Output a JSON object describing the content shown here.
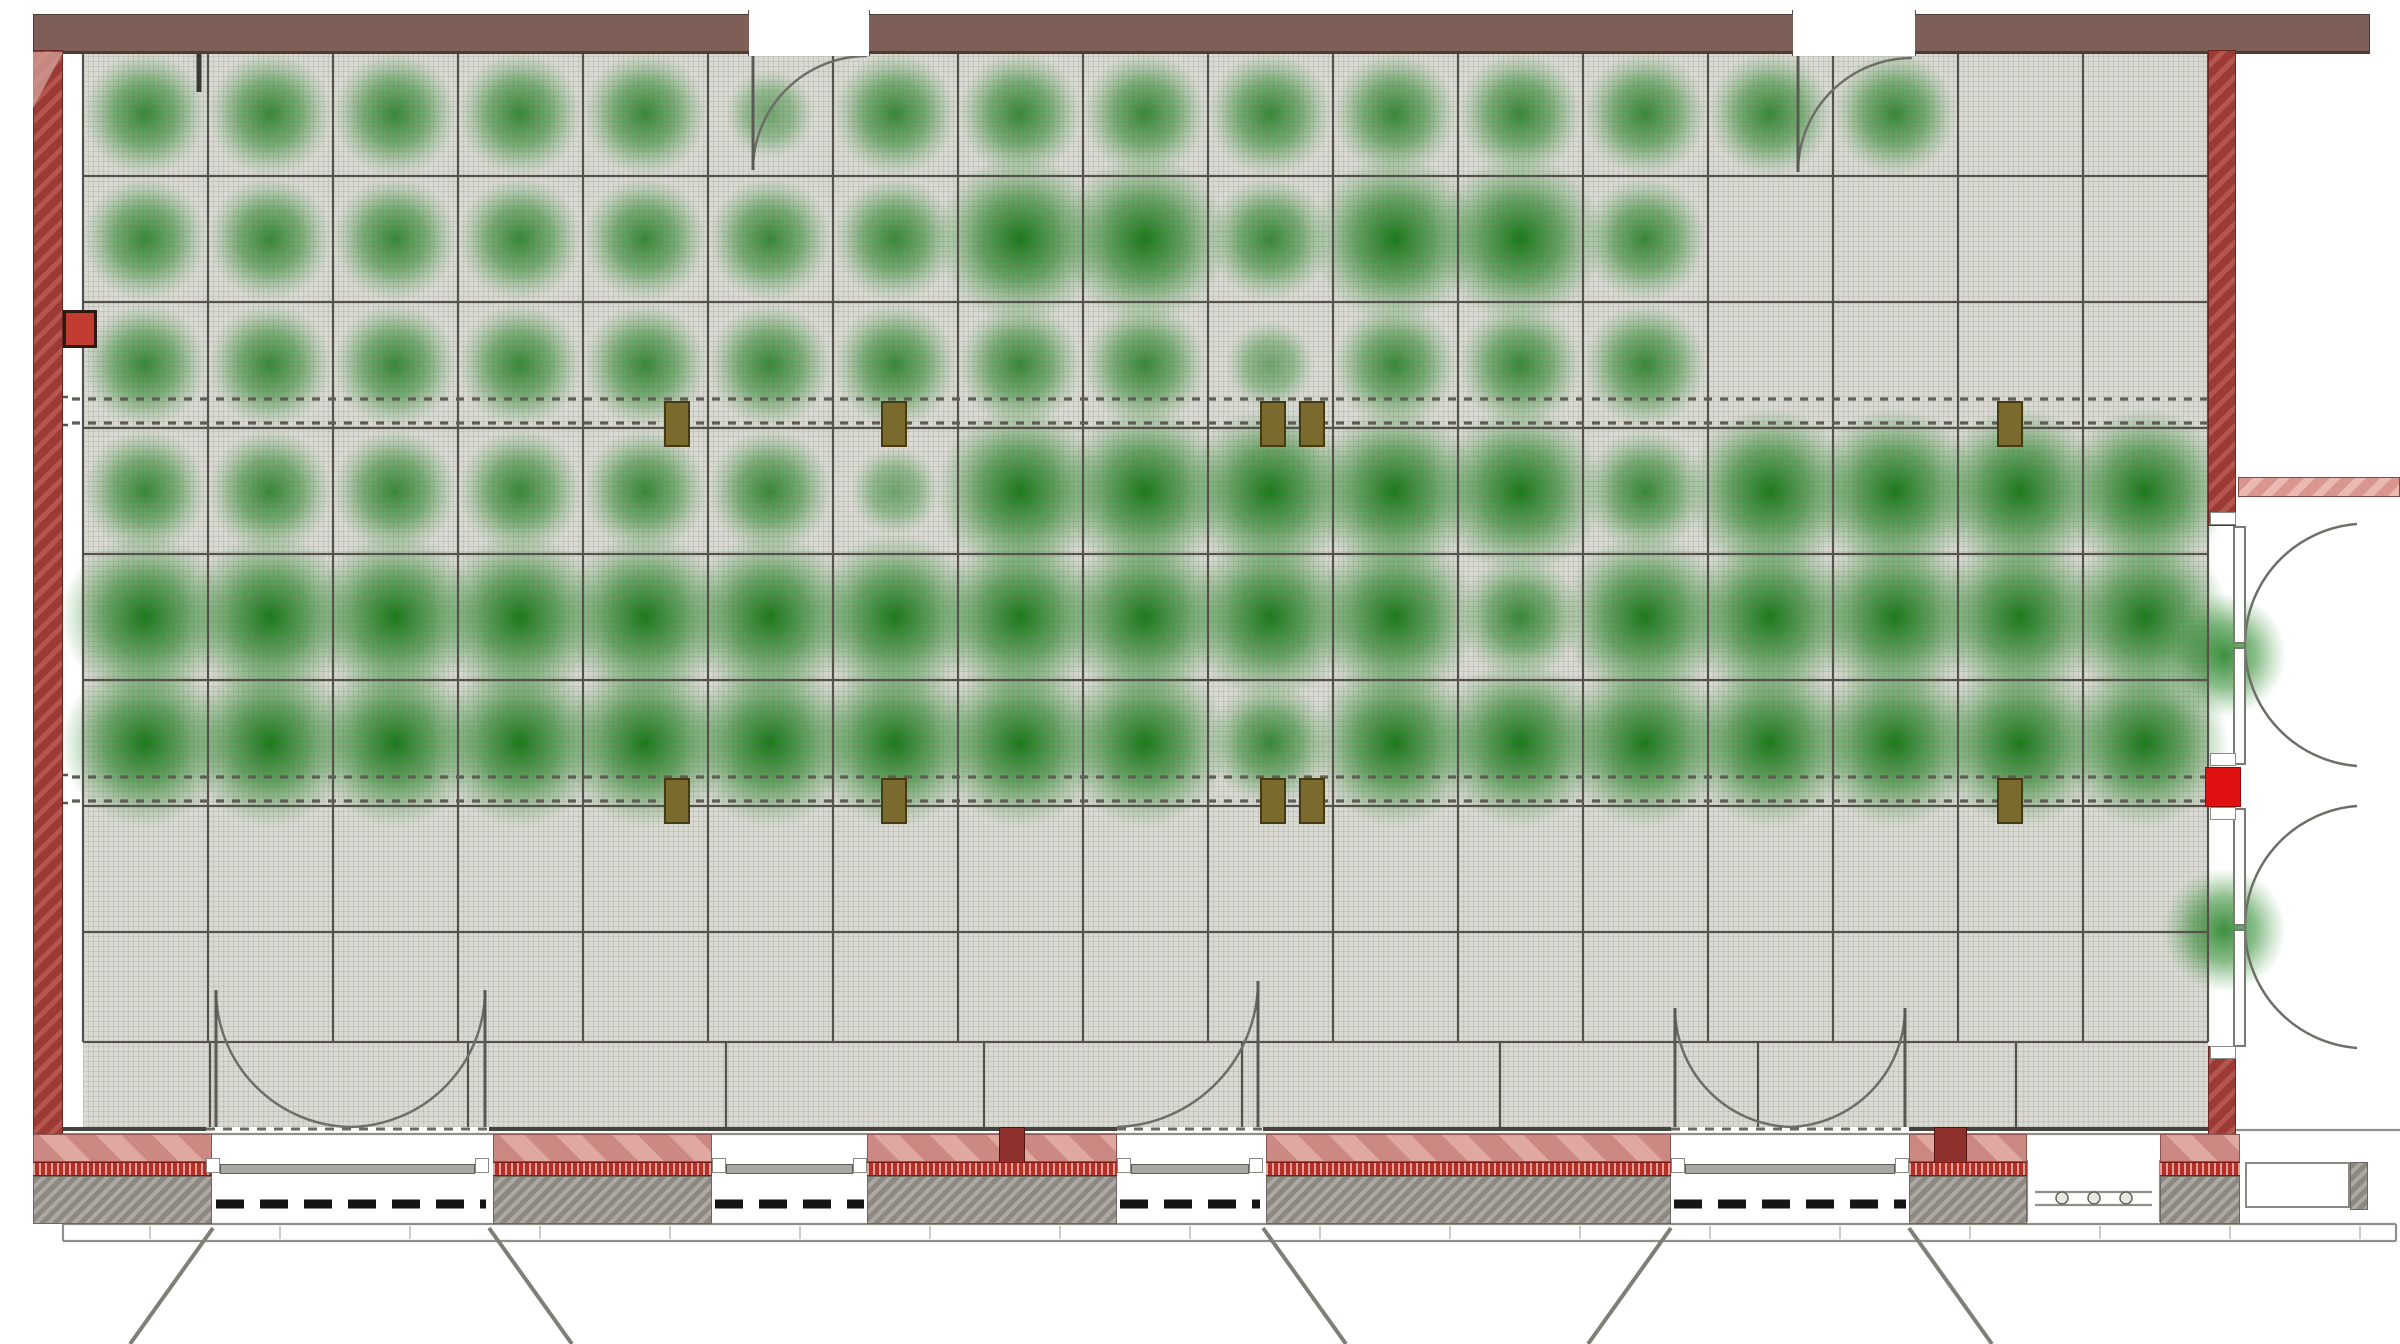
{
  "plan": {
    "canvas": {
      "w": 2400,
      "h": 1344
    },
    "colors": {
      "floor": "#dadad4",
      "wall_brown": "#7d5f57",
      "wall_red": "#a8443d",
      "bright_red": "#e01010",
      "green_core": "#147414",
      "pink_panel": "#d2928c",
      "red_strip": "#b52f25",
      "gray_pier": "#9c968f",
      "marker_olive": "#7a6a2e",
      "grid_line": "#54524b",
      "arc_line": "#6e6e68",
      "black_dash": "#151515"
    },
    "floor": {
      "x": 83,
      "y": 52,
      "w": 2125,
      "h": 1075
    },
    "grid": {
      "v_xs": [
        83,
        208,
        333,
        458,
        583,
        708,
        833,
        958,
        1083,
        1208,
        1333,
        1458,
        1583,
        1708,
        1833,
        1958,
        2083,
        2208
      ],
      "v_y1": 52,
      "v_y2": 1042,
      "h_ys": [
        52,
        176,
        302,
        428,
        554,
        680,
        806,
        932,
        1042
      ],
      "h_x1": 83,
      "h_x2": 2208,
      "walkway_xs": [
        210,
        468,
        726,
        984,
        1242,
        1500,
        1758,
        2016
      ],
      "walkway_y1": 1042,
      "walkway_y2": 1127
    },
    "blobs": {
      "col_centers": [
        145,
        270,
        395,
        520,
        645,
        770,
        895,
        1020,
        1145,
        1270,
        1395,
        1520,
        1645,
        1770,
        1895,
        2020,
        2145
      ],
      "row_centers": [
        114,
        239,
        365,
        491,
        617,
        743
      ],
      "matrix": [
        [
          2,
          2,
          2,
          2,
          2,
          1,
          2,
          2,
          2,
          2,
          2,
          2,
          2,
          2,
          2,
          0,
          0
        ],
        [
          2,
          2,
          2,
          2,
          2,
          2,
          2,
          3,
          3,
          2,
          3,
          3,
          2,
          0,
          0,
          0,
          0
        ],
        [
          2,
          2,
          2,
          2,
          2,
          2,
          2,
          2,
          2,
          1,
          2,
          2,
          2,
          0,
          0,
          0,
          0
        ],
        [
          2,
          2,
          2,
          2,
          2,
          2,
          1,
          3,
          3,
          3,
          3,
          3,
          2,
          3,
          3,
          3,
          3
        ],
        [
          3,
          3,
          3,
          3,
          3,
          3,
          3,
          3,
          3,
          3,
          3,
          2,
          3,
          3,
          3,
          3,
          3
        ],
        [
          3,
          3,
          3,
          3,
          3,
          3,
          3,
          3,
          3,
          2,
          3,
          3,
          3,
          3,
          3,
          3,
          3
        ]
      ],
      "extra": [
        {
          "x": 2224,
          "y": 655,
          "i": 2
        },
        {
          "x": 2224,
          "y": 930,
          "i": 2
        }
      ]
    },
    "rects": [
      {
        "n": "top-wall",
        "x": 33,
        "y": 14,
        "w": 2337,
        "h": 40,
        "c": "wallBrown"
      },
      {
        "n": "top-door-gap-1",
        "x": 749,
        "y": 10,
        "w": 120,
        "h": 46,
        "c": "white"
      },
      {
        "n": "top-door-gap-2",
        "x": 1793,
        "y": 10,
        "w": 122,
        "h": 46,
        "c": "white"
      },
      {
        "n": "left-wall",
        "x": 33,
        "y": 50,
        "w": 30,
        "h": 1086,
        "c": "wallRed"
      },
      {
        "n": "left-wall-corner-bevel",
        "x": 33,
        "y": 52,
        "w": 30,
        "h": 56,
        "c": "cornerTri"
      },
      {
        "n": "right-wall-upper",
        "x": 2208,
        "y": 50,
        "w": 28,
        "h": 476,
        "c": "wallRed"
      },
      {
        "n": "right-wall-lower",
        "x": 2208,
        "y": 1046,
        "w": 28,
        "h": 92,
        "c": "wallRed"
      },
      {
        "n": "right-wall-red-block",
        "x": 2205,
        "y": 767,
        "w": 36,
        "h": 40,
        "c": "redBright"
      },
      {
        "n": "right-pink-ledge",
        "x": 2238,
        "y": 477,
        "w": 162,
        "h": 20,
        "c": "pinkHatchR"
      },
      {
        "n": "outlet-box",
        "x": 63,
        "y": 310,
        "w": 34,
        "h": 38,
        "c": "outlet"
      },
      {
        "n": "window-panel-1",
        "x": 33,
        "y": 1134,
        "w": 179,
        "h": 28,
        "c": "pinkPanel"
      },
      {
        "n": "window-panel-2",
        "x": 493,
        "y": 1134,
        "w": 219,
        "h": 28,
        "c": "pinkPanel"
      },
      {
        "n": "window-panel-3",
        "x": 867,
        "y": 1134,
        "w": 250,
        "h": 28,
        "c": "pinkPanel"
      },
      {
        "n": "window-panel-4",
        "x": 1266,
        "y": 1134,
        "w": 405,
        "h": 28,
        "c": "pinkPanel"
      },
      {
        "n": "window-panel-5",
        "x": 1909,
        "y": 1134,
        "w": 118,
        "h": 28,
        "c": "pinkPanel"
      },
      {
        "n": "window-panel-6",
        "x": 2160,
        "y": 1134,
        "w": 80,
        "h": 28,
        "c": "pinkPanel"
      },
      {
        "n": "mullion-1",
        "x": 999,
        "y": 1127,
        "w": 26,
        "h": 36,
        "c": "redDark"
      },
      {
        "n": "mullion-2",
        "x": 1934,
        "y": 1127,
        "w": 33,
        "h": 36,
        "c": "redDark"
      },
      {
        "n": "red-strip-1",
        "x": 33,
        "y": 1162,
        "w": 179,
        "h": 14,
        "c": "redStrip"
      },
      {
        "n": "red-strip-2",
        "x": 493,
        "y": 1162,
        "w": 219,
        "h": 14,
        "c": "redStrip"
      },
      {
        "n": "red-strip-3",
        "x": 867,
        "y": 1162,
        "w": 250,
        "h": 14,
        "c": "redStrip"
      },
      {
        "n": "red-strip-4",
        "x": 1266,
        "y": 1162,
        "w": 405,
        "h": 14,
        "c": "redStrip"
      },
      {
        "n": "red-strip-5",
        "x": 1909,
        "y": 1162,
        "w": 118,
        "h": 14,
        "c": "redStrip"
      },
      {
        "n": "red-strip-6",
        "x": 2160,
        "y": 1162,
        "w": 80,
        "h": 14,
        "c": "redStrip"
      },
      {
        "n": "masonry-pier-1",
        "x": 33,
        "y": 1176,
        "w": 179,
        "h": 48,
        "c": "grayPier"
      },
      {
        "n": "masonry-pier-2",
        "x": 493,
        "y": 1176,
        "w": 219,
        "h": 48,
        "c": "grayPier"
      },
      {
        "n": "masonry-pier-3",
        "x": 867,
        "y": 1176,
        "w": 250,
        "h": 48,
        "c": "grayPier"
      },
      {
        "n": "masonry-pier-4",
        "x": 1266,
        "y": 1176,
        "w": 405,
        "h": 48,
        "c": "grayPier"
      },
      {
        "n": "masonry-pier-5",
        "x": 1909,
        "y": 1176,
        "w": 118,
        "h": 48,
        "c": "grayPier"
      },
      {
        "n": "masonry-pier-6",
        "x": 2160,
        "y": 1176,
        "w": 80,
        "h": 48,
        "c": "grayPier"
      },
      {
        "n": "masonry-pier-east",
        "x": 2350,
        "y": 1162,
        "w": 18,
        "h": 48,
        "c": "grayPier"
      },
      {
        "n": "window-frame-east",
        "x": 2245,
        "y": 1162,
        "w": 105,
        "h": 46,
        "c": "frame"
      },
      {
        "n": "door-jamb",
        "x": 206,
        "y": 1158,
        "w": 14,
        "h": 15,
        "c": "jamb"
      },
      {
        "n": "door-jamb",
        "x": 475,
        "y": 1158,
        "w": 14,
        "h": 15,
        "c": "jamb"
      },
      {
        "n": "door-jamb",
        "x": 712,
        "y": 1158,
        "w": 14,
        "h": 15,
        "c": "jamb"
      },
      {
        "n": "door-jamb",
        "x": 853,
        "y": 1158,
        "w": 14,
        "h": 15,
        "c": "jamb"
      },
      {
        "n": "door-jamb",
        "x": 1117,
        "y": 1158,
        "w": 14,
        "h": 15,
        "c": "jamb"
      },
      {
        "n": "door-jamb",
        "x": 1249,
        "y": 1158,
        "w": 14,
        "h": 15,
        "c": "jamb"
      },
      {
        "n": "door-jamb",
        "x": 1671,
        "y": 1158,
        "w": 14,
        "h": 15,
        "c": "jamb"
      },
      {
        "n": "door-jamb",
        "x": 1895,
        "y": 1158,
        "w": 14,
        "h": 15,
        "c": "jamb"
      },
      {
        "n": "door-sill",
        "x": 220,
        "y": 1164,
        "w": 255,
        "h": 10,
        "c": "sillbar"
      },
      {
        "n": "door-sill",
        "x": 726,
        "y": 1164,
        "w": 127,
        "h": 10,
        "c": "sillbar"
      },
      {
        "n": "door-sill",
        "x": 1131,
        "y": 1164,
        "w": 118,
        "h": 10,
        "c": "sillbar"
      },
      {
        "n": "door-sill",
        "x": 1685,
        "y": 1164,
        "w": 210,
        "h": 10,
        "c": "sillbar"
      },
      {
        "n": "door-leaf-east",
        "x": 2233,
        "y": 526,
        "w": 13,
        "h": 118,
        "c": "leaf"
      },
      {
        "n": "door-leaf-east",
        "x": 2233,
        "y": 647,
        "w": 13,
        "h": 118,
        "c": "leaf"
      },
      {
        "n": "door-leaf-east",
        "x": 2233,
        "y": 808,
        "w": 13,
        "h": 118,
        "c": "leaf"
      },
      {
        "n": "door-leaf-east",
        "x": 2233,
        "y": 929,
        "w": 13,
        "h": 118,
        "c": "leaf"
      },
      {
        "n": "door-jamb",
        "x": 2210,
        "y": 512,
        "w": 26,
        "h": 13,
        "c": "jamb"
      },
      {
        "n": "door-jamb",
        "x": 2210,
        "y": 753,
        "w": 26,
        "h": 13,
        "c": "jamb"
      },
      {
        "n": "door-jamb",
        "x": 2210,
        "y": 807,
        "w": 26,
        "h": 13,
        "c": "jamb"
      },
      {
        "n": "door-jamb",
        "x": 2210,
        "y": 1046,
        "w": 26,
        "h": 13,
        "c": "jamb"
      }
    ],
    "markers": {
      "w": 26,
      "h": 46,
      "band_ys": [
        401,
        778
      ],
      "center_xs": [
        677,
        894,
        1273,
        1312,
        2010
      ]
    },
    "svg": {
      "wall_solid": [
        [
          63,
          1129,
          206,
          1129
        ],
        [
          489,
          1129,
          1117,
          1129
        ],
        [
          1263,
          1129,
          1671,
          1129
        ],
        [
          1909,
          1129,
          2212,
          1129
        ]
      ],
      "thin": [
        [
          63,
          1134,
          2212,
          1134
        ],
        [
          2212,
          1130,
          2400,
          1130
        ],
        [
          63,
          1224,
          2396,
          1224
        ],
        [
          63,
          1241,
          2396,
          1241
        ],
        [
          63,
          1224,
          63,
          1241
        ],
        [
          2396,
          1224,
          2396,
          1241
        ],
        [
          2035,
          1192,
          2152,
          1192
        ],
        [
          2035,
          1205,
          2152,
          1205
        ],
        [
          2027,
          1160,
          2027,
          1222
        ],
        [
          2160,
          1160,
          2160,
          1222
        ]
      ],
      "dash_door": [
        [
          206,
          1129,
          489,
          1129
        ],
        [
          1117,
          1129,
          1263,
          1129
        ],
        [
          1671,
          1129,
          1909,
          1129
        ]
      ],
      "dash_band": [
        [
          72,
          399,
          2212,
          399
        ],
        [
          72,
          423,
          2212,
          423
        ],
        [
          72,
          777,
          2212,
          777
        ],
        [
          72,
          801,
          2212,
          801
        ]
      ],
      "brackets": [
        [
          50,
          397,
          68,
          397
        ],
        [
          50,
          397,
          50,
          409
        ],
        [
          50,
          413,
          50,
          425
        ],
        [
          50,
          425,
          68,
          425
        ],
        [
          50,
          775,
          68,
          775
        ],
        [
          50,
          775,
          50,
          787
        ],
        [
          50,
          791,
          50,
          803
        ],
        [
          50,
          803,
          68,
          803
        ]
      ],
      "black_dash": [
        [
          216,
          1204,
          486,
          1204
        ],
        [
          715,
          1204,
          864,
          1204
        ],
        [
          1120,
          1204,
          1260,
          1204
        ],
        [
          1674,
          1204,
          1906,
          1204
        ]
      ],
      "black_dash_thin": [
        [
          2252,
          1196,
          2344,
          1196
        ]
      ],
      "arcs": [
        "M 753 170 A 114 114 0 0 1 867 56",
        "M 1798 172 A 114 114 0 0 1 1912 58",
        "M 216 990 A 137 137 0 0 0 351 1127",
        "M 485 990 A 137 137 0 0 1 351 1127",
        "M 1258 981 A 146 146 0 0 1 1117 1127",
        "M 1675 1008 A 119 119 0 0 0 1790 1127",
        "M 1905 1008 A 119 119 0 0 1 1790 1127",
        "M 2245 645 A 121 121 0 0 1 2357 524",
        "M 2245 645 A 121 121 0 0 0 2357 766",
        "M 2245 927 A 121 121 0 0 1 2357 806",
        "M 2245 927 A 121 121 0 0 0 2357 1048"
      ],
      "leaf_lines": [
        [
          753,
          56,
          753,
          170
        ],
        [
          1798,
          56,
          1798,
          172
        ],
        [
          216,
          990,
          216,
          1127
        ],
        [
          485,
          990,
          485,
          1127
        ],
        [
          1258,
          981,
          1258,
          1127
        ],
        [
          1675,
          1008,
          1675,
          1127
        ],
        [
          1905,
          1008,
          1905,
          1127
        ]
      ],
      "top_jambs": [
        [
          749,
          10,
          749,
          56
        ],
        [
          869,
          10,
          869,
          56
        ],
        [
          1793,
          10,
          1793,
          56
        ],
        [
          1915,
          10,
          1915,
          56
        ]
      ],
      "thick_ticks": [
        [
          199,
          54,
          199,
          92
        ]
      ],
      "diagonals": [
        [
          213,
          1228,
          130,
          1344
        ],
        [
          489,
          1228,
          572,
          1344
        ],
        [
          1263,
          1228,
          1346,
          1344
        ],
        [
          1671,
          1228,
          1588,
          1344
        ],
        [
          1909,
          1228,
          1992,
          1344
        ]
      ],
      "ticks_y": [
        1226,
        1239
      ],
      "ticks_xs": [
        150,
        280,
        410,
        540,
        670,
        800,
        930,
        1060,
        1190,
        1320,
        1450,
        1580,
        1710,
        1840,
        1970,
        2100,
        2230,
        2360
      ],
      "circles": [
        [
          2062,
          1198,
          6
        ],
        [
          2094,
          1198,
          6
        ],
        [
          2126,
          1198,
          6
        ]
      ]
    }
  }
}
